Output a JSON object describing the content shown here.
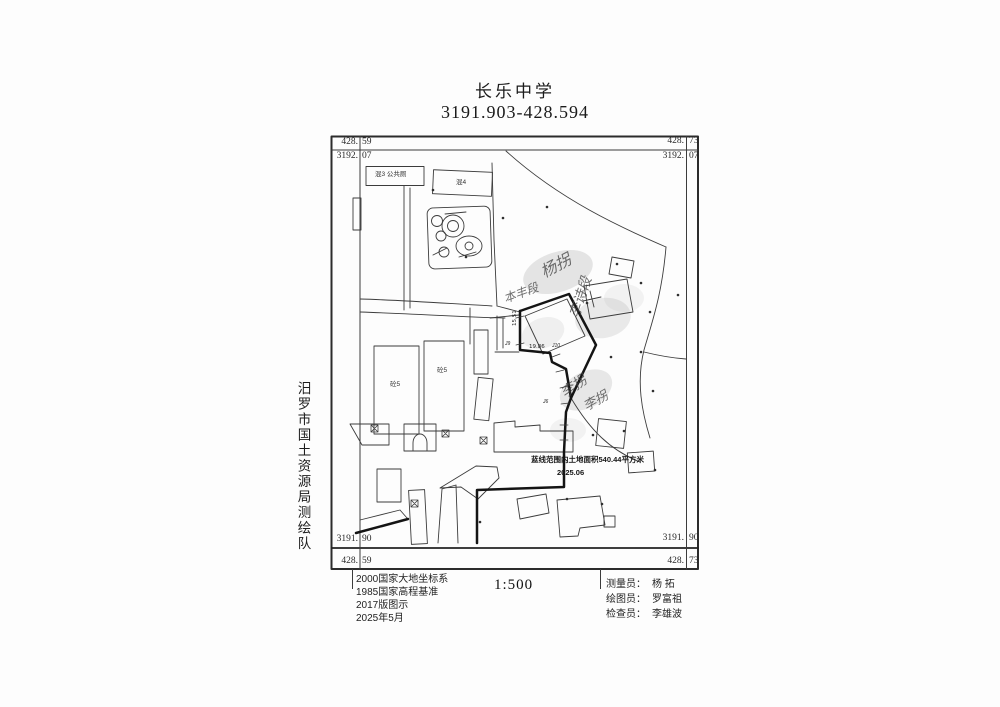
{
  "header": {
    "school_name": "长乐中学",
    "sheet_number": "3191.903-428.594"
  },
  "sidebar": {
    "org_name_vertical": "汨罗市国土资源局测绘队"
  },
  "map": {
    "corners": {
      "top_left": {
        "e_int": "428.",
        "e_dec": "59",
        "n_int": "3192.",
        "n_dec": "07"
      },
      "top_right": {
        "e_int": "428.",
        "e_dec": "73",
        "n_int": "3192.",
        "n_dec": "07"
      },
      "bottom_left": {
        "n_int": "3191.",
        "n_dec": "90",
        "e_int": "428.",
        "e_dec": "59"
      },
      "bottom_right": {
        "n_int": "3191.",
        "n_dec": "90",
        "e_int": "428.",
        "e_dec": "73"
      }
    },
    "labels": {
      "building_top_left": "混3 公共厕",
      "building_top_right": "混4",
      "building_mid_1": "砼5",
      "building_mid_2": "砼5",
      "dim_vertical": "15.51",
      "dim_horizontal": "19.86",
      "point_1": "J9",
      "point_2": "J10",
      "point_3": "J6",
      "area_note": "蓝线范围内土地面积540.44平方米",
      "area_date": "2025.06"
    },
    "handwriting": [
      "杨拐",
      "本丰段",
      "李诗段",
      "李拐",
      "李拐"
    ]
  },
  "footer": {
    "datum_lines": [
      "2000国家大地坐标系",
      "1985国家高程基准",
      "2017版图示",
      "2025年5月"
    ],
    "scale": "1:500",
    "staff": [
      {
        "role": "测量员：",
        "name": "杨  拓"
      },
      {
        "role": "绘图员：",
        "name": "罗富祖"
      },
      {
        "role": "检查员：",
        "name": "李雄波"
      }
    ]
  }
}
